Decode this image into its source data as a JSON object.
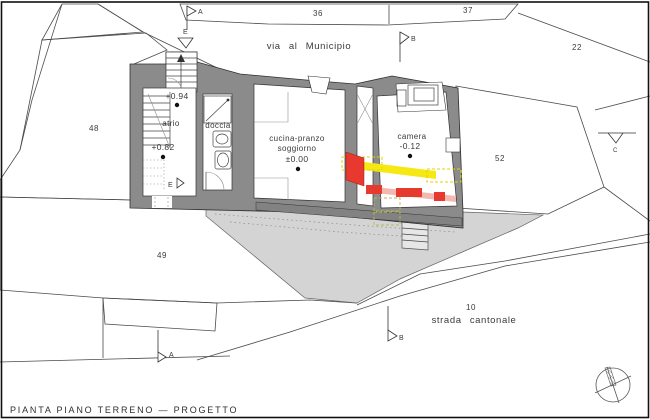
{
  "page": {
    "title": "PIANTA PIANO TERRENO — PROGETTO"
  },
  "roads": {
    "via": "via al Municipio",
    "strada": "strada cantonale"
  },
  "parcels": {
    "p36": "36",
    "p37": "37",
    "p22": "22",
    "p48": "48",
    "p52": "52",
    "p49": "49",
    "p10": "10"
  },
  "rooms": {
    "atrio": {
      "name": "atrio",
      "elev_upper": "+0.94",
      "elev_lower": "+0.82"
    },
    "doccia": {
      "name": "doccia"
    },
    "cucina": {
      "line1": "cucina-pranzo",
      "line2": "soggiorno",
      "elev": "±0.00"
    },
    "camera": {
      "name": "camera",
      "elev": "-0.12"
    }
  },
  "markers": {
    "a": "A",
    "b": "B",
    "c": "C",
    "e": "E"
  },
  "colors": {
    "existing_wall": "#8b8b8b",
    "retaining_wall": "#828282",
    "new_construction_red": "#e8392f",
    "new_construction_pink": "#f3b9b0",
    "demolition_yellow": "#f6e813",
    "demolition_dashed_olive": "#b5ba55",
    "terrace_gray": "#d4d4d4",
    "hatch_gray": "#cfcfcf"
  }
}
